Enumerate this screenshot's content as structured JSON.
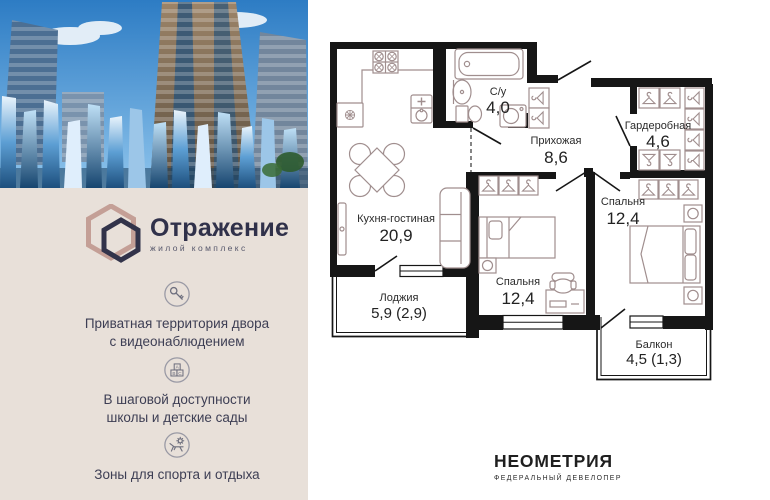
{
  "project": {
    "logo_title": "Отражение",
    "logo_subtitle": "жилой комплекс"
  },
  "features": [
    {
      "icon": "key-icon",
      "lines": [
        "Приватная территория двора",
        "с видеонаблюдением"
      ]
    },
    {
      "icon": "abc-blocks-icon",
      "lines": [
        "В шаговой доступности",
        "школы и детские сады"
      ]
    },
    {
      "icon": "lounge-sun-icon",
      "lines": [
        "Зоны для спорта и отдыха"
      ]
    }
  ],
  "floor_plan": {
    "rooms": [
      {
        "name": "Кухня-гостиная",
        "area": "20,9"
      },
      {
        "name": "С/у",
        "area": "4,0"
      },
      {
        "name": "Прихожая",
        "area": "8,6"
      },
      {
        "name": "Гардеробная",
        "area": "4,6"
      },
      {
        "name": "Спальня",
        "area": "12,4"
      },
      {
        "name": "Спальня",
        "area": "12,4"
      },
      {
        "name": "Лоджия",
        "area": "5,9 (2,9)"
      },
      {
        "name": "Балкон",
        "area": "4,5 (1,3)"
      }
    ]
  },
  "developer": {
    "name": "НЕОМЕТРИЯ",
    "tagline": "ФЕДЕРАЛЬНЫЙ ДЕВЕЛОПЕР"
  },
  "colors": {
    "beige_panel": "#e8e0d9",
    "brand_dark": "#30314a",
    "accent_rose": "#bd9389",
    "wall": "#161616",
    "furniture": "#a08e8e"
  }
}
